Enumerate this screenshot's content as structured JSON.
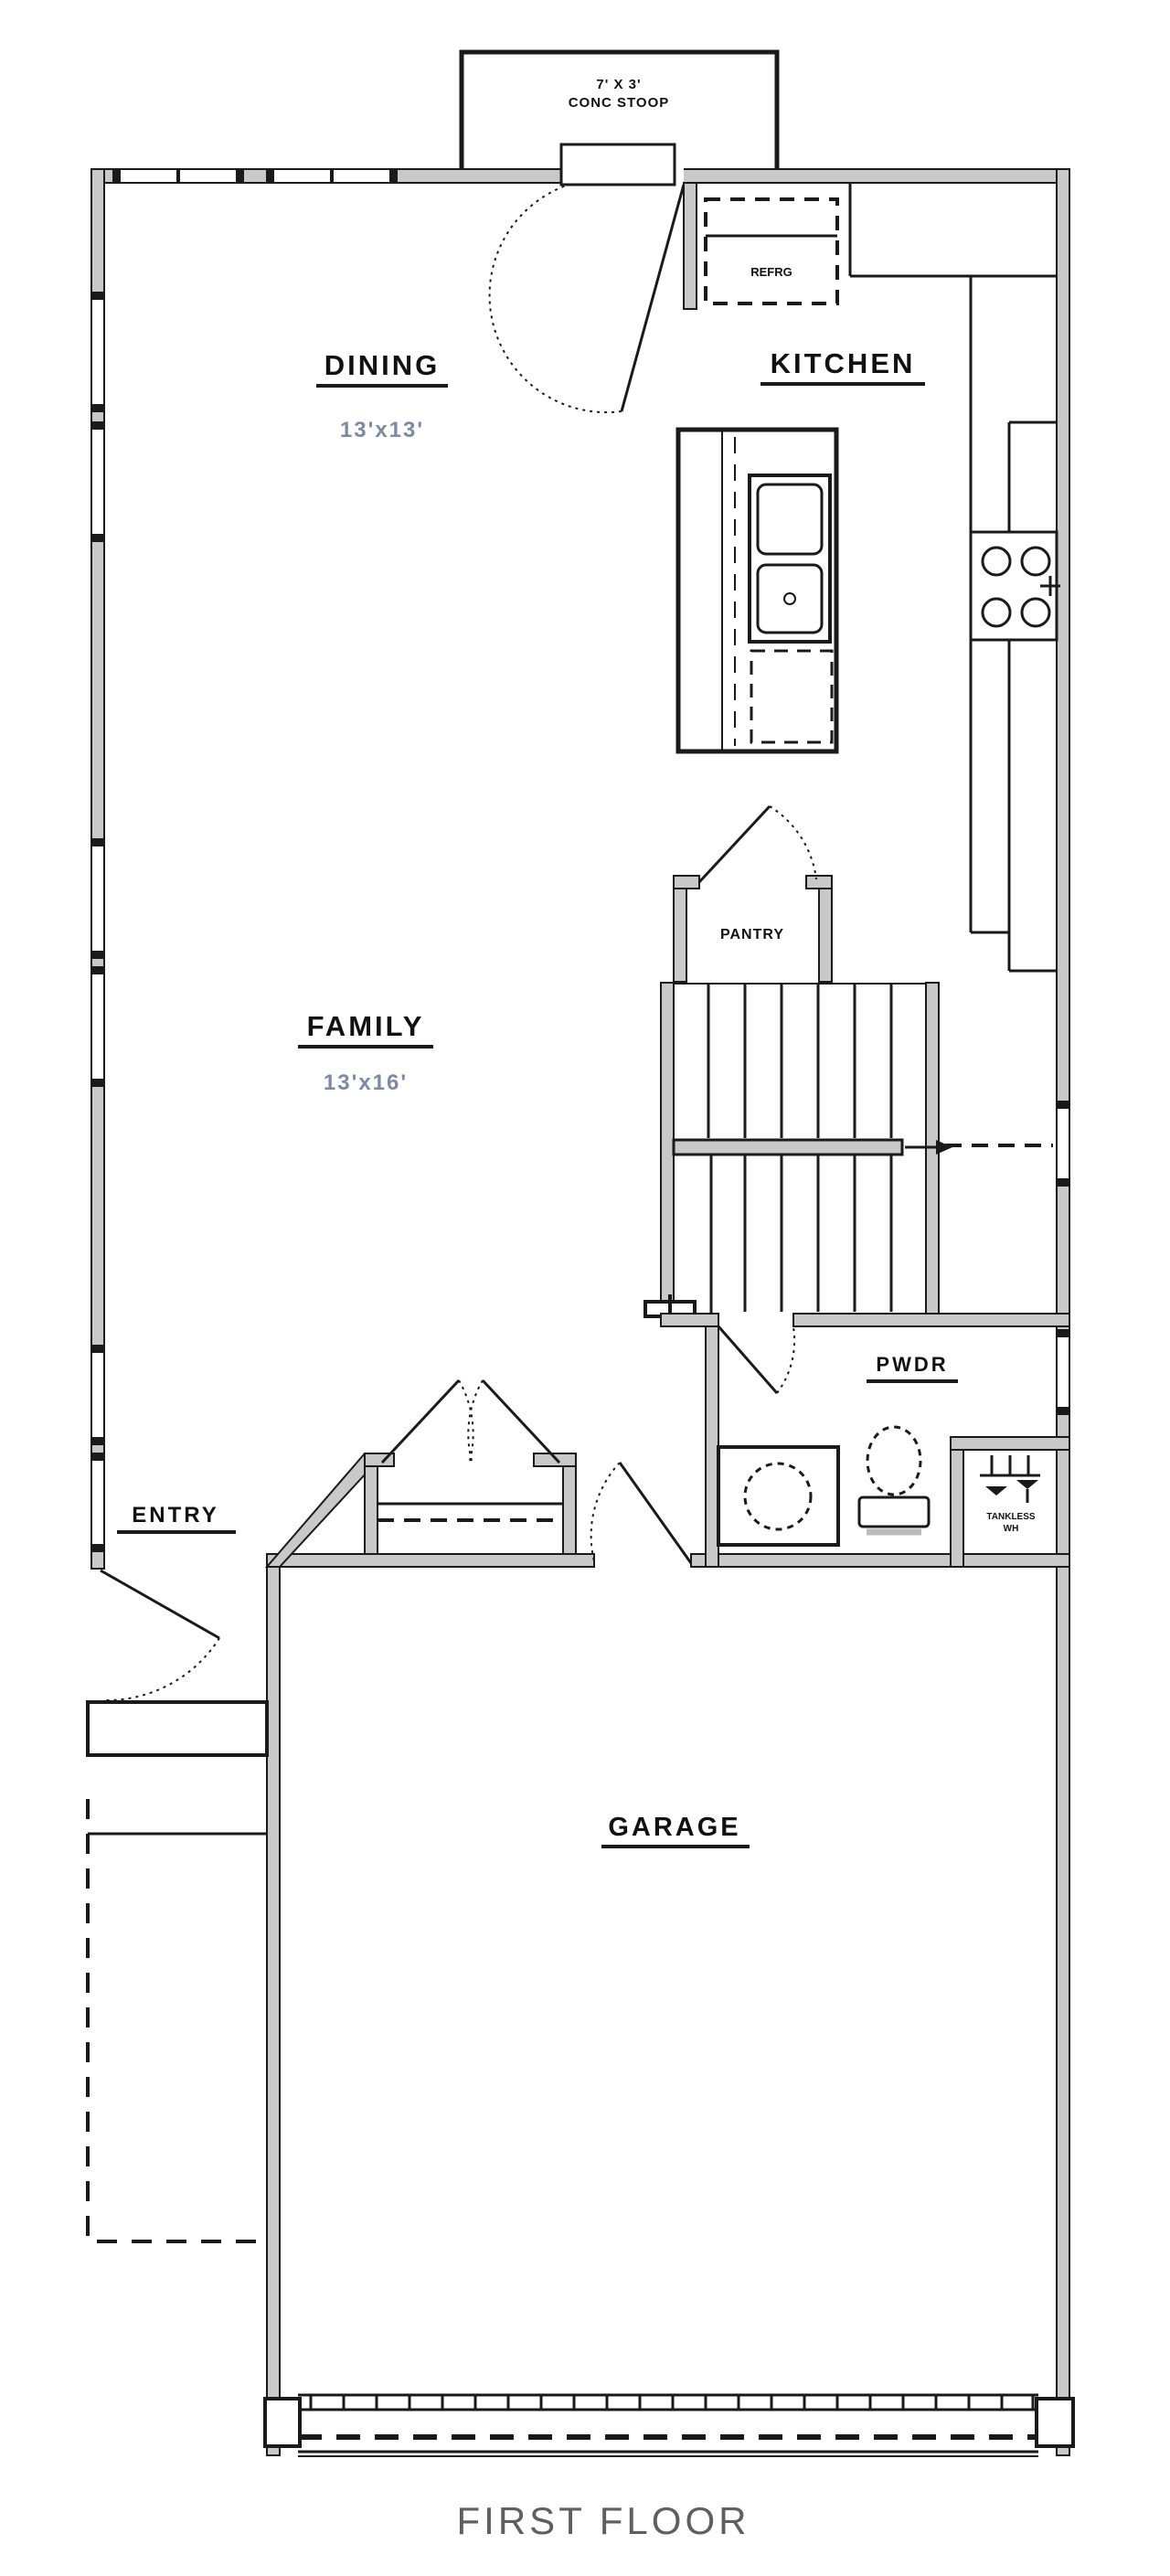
{
  "title": "FIRST FLOOR",
  "colors": {
    "background": "#ffffff",
    "wall_fill": "#c9c9c9",
    "line": "#1a1a1a",
    "dim_text": "#7d8aa0",
    "title_text": "#5f5f5f"
  },
  "stoop": {
    "line1": "7' X 3'",
    "line2": "CONC STOOP"
  },
  "rooms": {
    "dining": {
      "name": "DINING",
      "dim": "13'x13'"
    },
    "kitchen": {
      "name": "KITCHEN"
    },
    "family": {
      "name": "FAMILY",
      "dim": "13'x16'"
    },
    "entry": {
      "name": "ENTRY"
    },
    "pantry": {
      "name": "PANTRY"
    },
    "powder": {
      "name": "PWDR"
    },
    "garage": {
      "name": "GARAGE"
    }
  },
  "fixtures": {
    "refrigerator": "REFRG",
    "water_heater_line1": "TANKLESS",
    "water_heater_line2": "WH"
  }
}
